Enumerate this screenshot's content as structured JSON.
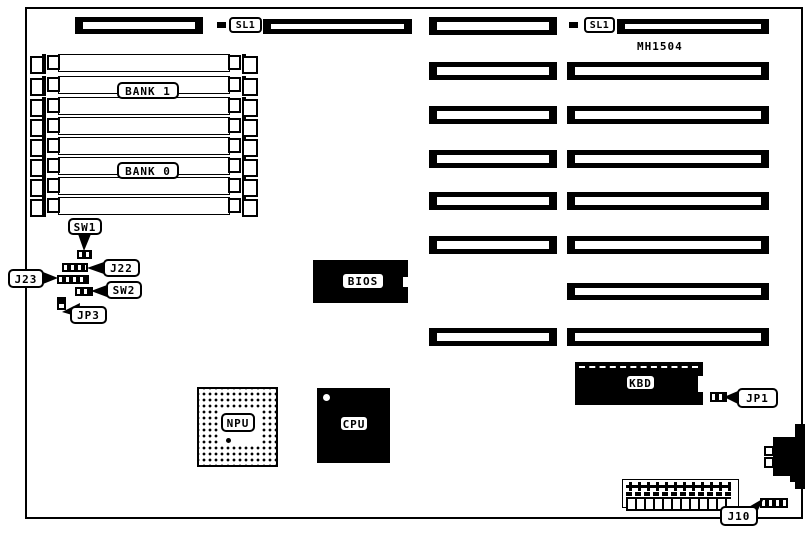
{
  "board": {
    "model": "MH1504",
    "colors": {
      "ink": "#000000",
      "paper": "#ffffff"
    },
    "labels": {
      "sl1_left": "SL1",
      "sl1_right": "SL1",
      "bank1": "BANK 1",
      "bank0": "BANK 0",
      "sw1": "SW1",
      "j22": "J22",
      "j23": "J23",
      "sw2": "SW2",
      "jp3": "JP3",
      "bios": "BIOS",
      "npu": "NPU",
      "cpu": "CPU",
      "kbd": "KBD",
      "jp1": "JP1",
      "j10": "J10"
    },
    "icons": {
      "expansion_slot": "black bar with white contact stripe",
      "simm_socket": "comb pin row",
      "din_connector": "stepped edge connector"
    }
  }
}
